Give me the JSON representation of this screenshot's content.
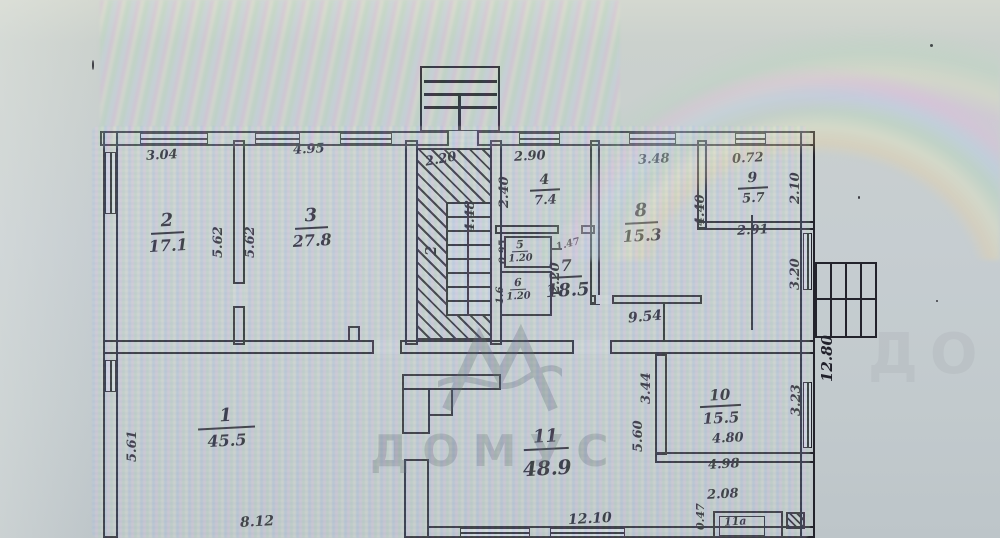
{
  "document": {
    "kind": "scanned floor plan"
  },
  "watermark": {
    "text": "ДОМУС",
    "partial": "ДО"
  },
  "rooms": [
    {
      "num": "1",
      "area": "45.5"
    },
    {
      "num": "2",
      "area": "17.1"
    },
    {
      "num": "3",
      "area": "27.8"
    },
    {
      "num": "4",
      "area": "7.4"
    },
    {
      "num": "5",
      "area": "1.20"
    },
    {
      "num": "6",
      "area": "1.20"
    },
    {
      "num": "7",
      "area": "18.5"
    },
    {
      "num": "8",
      "area": "15.3"
    },
    {
      "num": "9",
      "area": "5.7"
    },
    {
      "num": "10",
      "area": "15.5"
    },
    {
      "num": "11",
      "area": "48.9"
    },
    {
      "num": "11а",
      "area": ""
    }
  ],
  "dims": [
    "3.04",
    "4.95",
    "2.20",
    "2.90",
    "3.48",
    "0.72",
    "5.62",
    "5.62",
    "2.40",
    "4.48",
    "2",
    "0.95",
    "1.6",
    "1.47",
    "2.20",
    "4.40",
    "2.10",
    "2.91",
    "3.20",
    "12.80",
    "9.54",
    "5.61",
    "8.12",
    "12.10",
    "3.44",
    "5.60",
    "3.23",
    "4.80",
    "4.98",
    "2.08",
    "0.47"
  ]
}
